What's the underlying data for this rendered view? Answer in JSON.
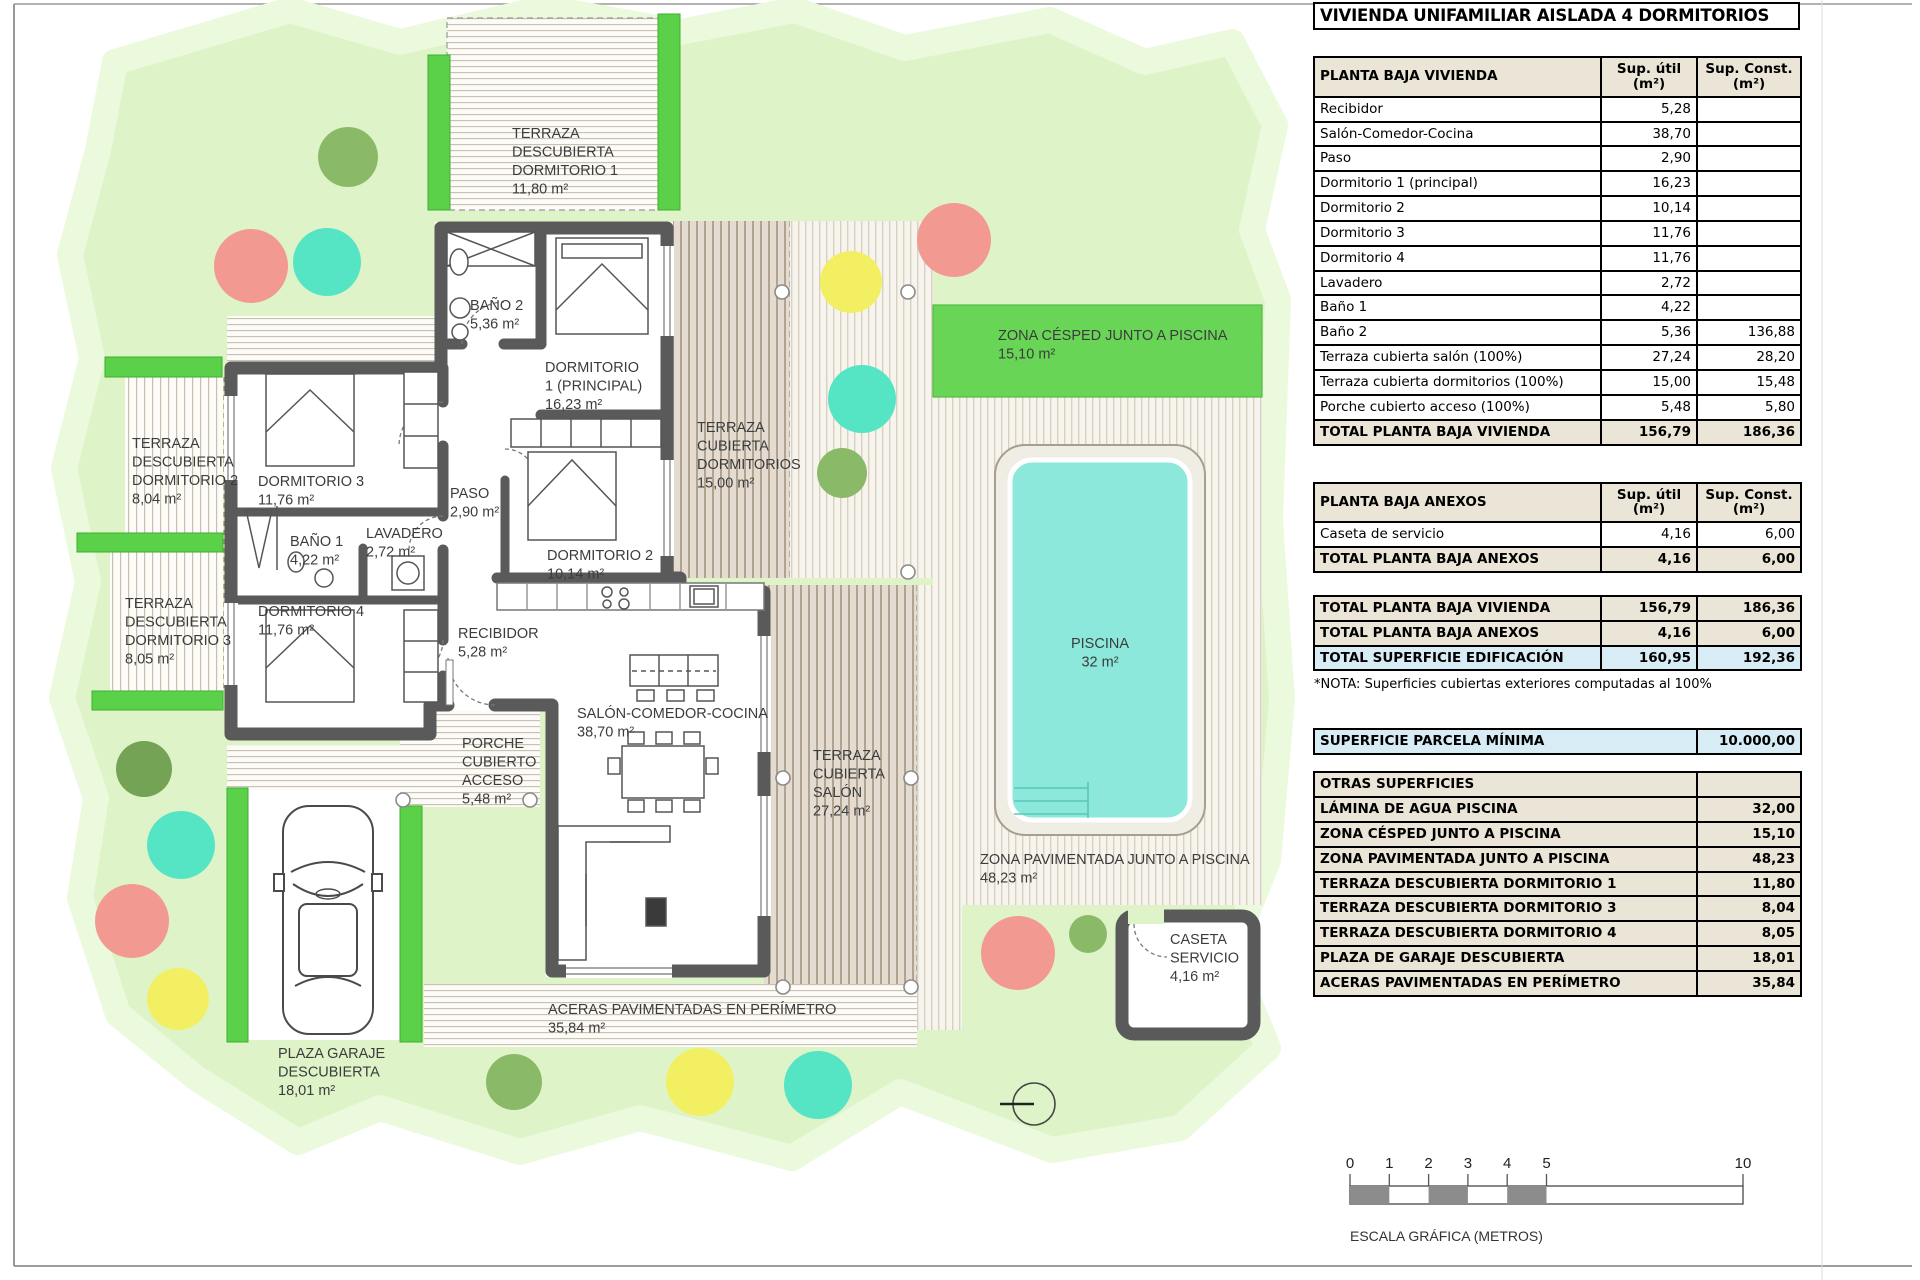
{
  "page": {
    "title": "VIVIENDA UNIFAMILIAR AISLADA 4 DORMITORIOS"
  },
  "columns": {
    "util_line1": "Sup. útil",
    "util_line2": "(m²)",
    "const_line1": "Sup. Const.",
    "const_line2": "(m²)"
  },
  "planta_baja_vivienda": {
    "header": "PLANTA BAJA VIVIENDA",
    "rows": [
      {
        "label": "Recibidor",
        "util": "5,28",
        "cons": ""
      },
      {
        "label": "Salón-Comedor-Cocina",
        "util": "38,70",
        "cons": ""
      },
      {
        "label": "Paso",
        "util": "2,90",
        "cons": ""
      },
      {
        "label": "Dormitorio 1 (principal)",
        "util": "16,23",
        "cons": ""
      },
      {
        "label": "Dormitorio 2",
        "util": "10,14",
        "cons": ""
      },
      {
        "label": "Dormitorio 3",
        "util": "11,76",
        "cons": ""
      },
      {
        "label": "Dormitorio 4",
        "util": "11,76",
        "cons": ""
      },
      {
        "label": "Lavadero",
        "util": "2,72",
        "cons": ""
      },
      {
        "label": "Baño 1",
        "util": "4,22",
        "cons": ""
      },
      {
        "label": "Baño 2",
        "util": "5,36",
        "cons": "136,88"
      },
      {
        "label": "Terraza cubierta salón (100%)",
        "util": "27,24",
        "cons": "28,20"
      },
      {
        "label": "Terraza cubierta dormitorios (100%)",
        "util": "15,00",
        "cons": "15,48"
      },
      {
        "label": "Porche cubierto acceso (100%)",
        "util": "5,48",
        "cons": "5,80"
      }
    ],
    "total": {
      "label": "TOTAL PLANTA BAJA VIVIENDA",
      "util": "156,79",
      "cons": "186,36"
    }
  },
  "planta_baja_anexos": {
    "header": "PLANTA BAJA ANEXOS",
    "rows": [
      {
        "label": "Caseta de servicio",
        "util": "4,16",
        "cons": "6,00"
      }
    ],
    "total": {
      "label": "TOTAL PLANTA BAJA ANEXOS",
      "util": "4,16",
      "cons": "6,00"
    }
  },
  "totales": {
    "rows": [
      {
        "label": "TOTAL PLANTA BAJA VIVIENDA",
        "util": "156,79",
        "cons": "186,36",
        "highlight": false
      },
      {
        "label": "TOTAL PLANTA BAJA ANEXOS",
        "util": "4,16",
        "cons": "6,00",
        "highlight": false
      },
      {
        "label": "TOTAL SUPERFICIE EDIFICACIÓN",
        "util": "160,95",
        "cons": "192,36",
        "highlight": true
      }
    ],
    "nota": "*NOTA: Superficies cubiertas exteriores computadas al 100%"
  },
  "parcela": {
    "label": "SUPERFICIE PARCELA MÍNIMA",
    "value": "10.000,00"
  },
  "otras_superficies": {
    "header": "OTRAS SUPERFICIES",
    "rows": [
      {
        "label": "LÁMINA DE AGUA PISCINA",
        "value": "32,00"
      },
      {
        "label": "ZONA CÉSPED JUNTO A PISCINA",
        "value": "15,10"
      },
      {
        "label": "ZONA PAVIMENTADA JUNTO A PISCINA",
        "value": "48,23"
      },
      {
        "label": "TERRAZA DESCUBIERTA DORMITORIO 1",
        "value": "11,80"
      },
      {
        "label": "TERRAZA DESCUBIERTA DORMITORIO 3",
        "value": "8,04"
      },
      {
        "label": "TERRAZA DESCUBIERTA DORMITORIO 4",
        "value": "8,05"
      },
      {
        "label": "PLAZA DE GARAJE DESCUBIERTA",
        "value": "18,01"
      },
      {
        "label": "ACERAS PAVIMENTADAS EN PERÍMETRO",
        "value": "35,84"
      }
    ]
  },
  "escala": {
    "ticks": [
      "0",
      "1",
      "2",
      "3",
      "4",
      "5",
      "10"
    ],
    "label": "ESCALA GRÁFICA (METROS)"
  },
  "plan": {
    "labels": [
      {
        "id": "terraza-descubierta-dormitorio-1",
        "x": 512,
        "y": 138,
        "anchor": "start",
        "lines": [
          "TERRAZA",
          "DESCUBIERTA",
          "DORMITORIO 1",
          "11,80 m²"
        ]
      },
      {
        "id": "terraza-descubierta-dormitorio-2",
        "x": 132,
        "y": 448,
        "anchor": "start",
        "lines": [
          "TERRAZA",
          "DESCUBIERTA",
          "DORMITORIO 2",
          "8,04 m²"
        ]
      },
      {
        "id": "terraza-descubierta-dormitorio-3",
        "x": 125,
        "y": 608,
        "anchor": "start",
        "lines": [
          "TERRAZA",
          "DESCUBIERTA",
          "DORMITORIO 3",
          "8,05 m²"
        ]
      },
      {
        "id": "bano-2",
        "x": 470,
        "y": 310,
        "anchor": "start",
        "lines": [
          "BAÑO 2",
          "5,36 m²"
        ]
      },
      {
        "id": "dormitorio-1",
        "x": 545,
        "y": 372,
        "anchor": "start",
        "lines": [
          "DORMITORIO",
          "1 (PRINCIPAL)",
          "16,23 m²"
        ]
      },
      {
        "id": "dormitorio-3",
        "x": 258,
        "y": 486,
        "anchor": "start",
        "lines": [
          "DORMITORIO 3",
          "11,76 m²"
        ]
      },
      {
        "id": "paso",
        "x": 450,
        "y": 498,
        "anchor": "start",
        "lines": [
          "PASO",
          "2,90 m²"
        ]
      },
      {
        "id": "bano-1",
        "x": 290,
        "y": 546,
        "anchor": "start",
        "lines": [
          "BAÑO 1",
          "4,22 m²"
        ]
      },
      {
        "id": "lavadero",
        "x": 366,
        "y": 538,
        "anchor": "start",
        "lines": [
          "LAVADERO",
          "2,72 m²"
        ]
      },
      {
        "id": "dormitorio-4",
        "x": 258,
        "y": 616,
        "anchor": "start",
        "lines": [
          "DORMITORIO 4",
          "11,76 m²"
        ]
      },
      {
        "id": "dormitorio-2",
        "x": 547,
        "y": 560,
        "anchor": "start",
        "lines": [
          "DORMITORIO 2",
          "10,14 m²"
        ]
      },
      {
        "id": "recibidor",
        "x": 458,
        "y": 638,
        "anchor": "start",
        "lines": [
          "RECIBIDOR",
          "5,28 m²"
        ]
      },
      {
        "id": "terraza-cubierta-dormitorios",
        "x": 697,
        "y": 432,
        "anchor": "start",
        "lines": [
          "TERRAZA",
          "CUBIERTA",
          "DORMITORIOS",
          "15,00 m²"
        ]
      },
      {
        "id": "salon-comedor-cocina",
        "x": 577,
        "y": 718,
        "anchor": "start",
        "lines": [
          "SALÓN-COMEDOR-COCINA",
          "38,70 m²"
        ]
      },
      {
        "id": "porche-cubierto-acceso",
        "x": 462,
        "y": 748,
        "anchor": "start",
        "lines": [
          "PORCHE",
          "CUBIERTO",
          "ACCESO",
          "5,48 m²"
        ]
      },
      {
        "id": "terraza-cubierta-salon",
        "x": 813,
        "y": 760,
        "anchor": "start",
        "lines": [
          "TERRAZA",
          "CUBIERTA",
          "SALÓN",
          "27,24 m²"
        ]
      },
      {
        "id": "zona-cesped-junto-a-piscina",
        "x": 998,
        "y": 340,
        "anchor": "start",
        "lines": [
          "ZONA CÉSPED JUNTO A PISCINA",
          "15,10 m²"
        ]
      },
      {
        "id": "piscina",
        "x": 1100,
        "y": 648,
        "anchor": "middle",
        "lines": [
          "PISCINA",
          "32 m²"
        ]
      },
      {
        "id": "zona-pavimentada-junto-a-piscina",
        "x": 980,
        "y": 864,
        "anchor": "start",
        "lines": [
          "ZONA PAVIMENTADA JUNTO A PISCINA",
          "48,23 m²"
        ]
      },
      {
        "id": "caseta-servicio",
        "x": 1170,
        "y": 944,
        "anchor": "start",
        "lines": [
          "CASETA",
          "SERVICIO",
          "4,16 m²"
        ]
      },
      {
        "id": "plaza-garaje-descubierta",
        "x": 278,
        "y": 1058,
        "anchor": "start",
        "lines": [
          "PLAZA GARAJE",
          "DESCUBIERTA",
          "18,01 m²"
        ]
      },
      {
        "id": "aceras-pavimentadas",
        "x": 548,
        "y": 1014,
        "anchor": "start",
        "lines": [
          "ACERAS PAVIMENTADAS EN PERÍMETRO",
          "35,84 m²"
        ]
      }
    ]
  },
  "colors": {
    "table_beige": "#eae5d6",
    "highlight_blue": "#d8ecf5",
    "parcel_green": "#def4c8",
    "bright_green": "#5ad148",
    "cesped_green": "#68d556",
    "pool_water": "#8ce8da",
    "wall_gray": "#5a5a5a"
  }
}
